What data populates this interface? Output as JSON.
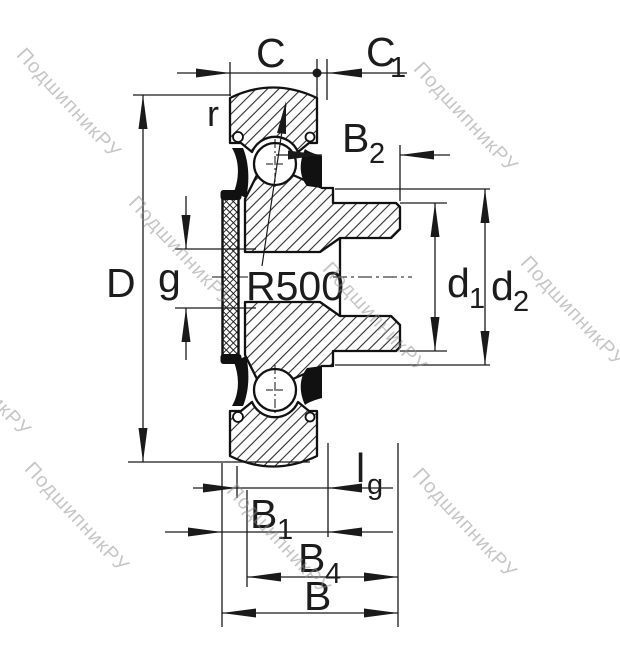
{
  "watermark": {
    "text": "ПодшипникРУ",
    "color": "#8f8f8f"
  },
  "drawing": {
    "line_color": "#1a1a1a",
    "labels": {
      "C": {
        "main": "C"
      },
      "C1": {
        "main": "C",
        "sub": "1"
      },
      "r": {
        "main": "r"
      },
      "B2": {
        "main": "B",
        "sub": "2"
      },
      "D": {
        "main": "D"
      },
      "g": {
        "main": "g"
      },
      "R500": {
        "main": "R500"
      },
      "d1": {
        "main": "d",
        "sub": "1"
      },
      "d2": {
        "main": "d",
        "sub": "2"
      },
      "lg": {
        "main": "l",
        "sub": "g"
      },
      "B1": {
        "main": "B",
        "sub": "1"
      },
      "B4": {
        "main": "B",
        "sub": "4"
      },
      "B": {
        "main": "B"
      }
    }
  }
}
